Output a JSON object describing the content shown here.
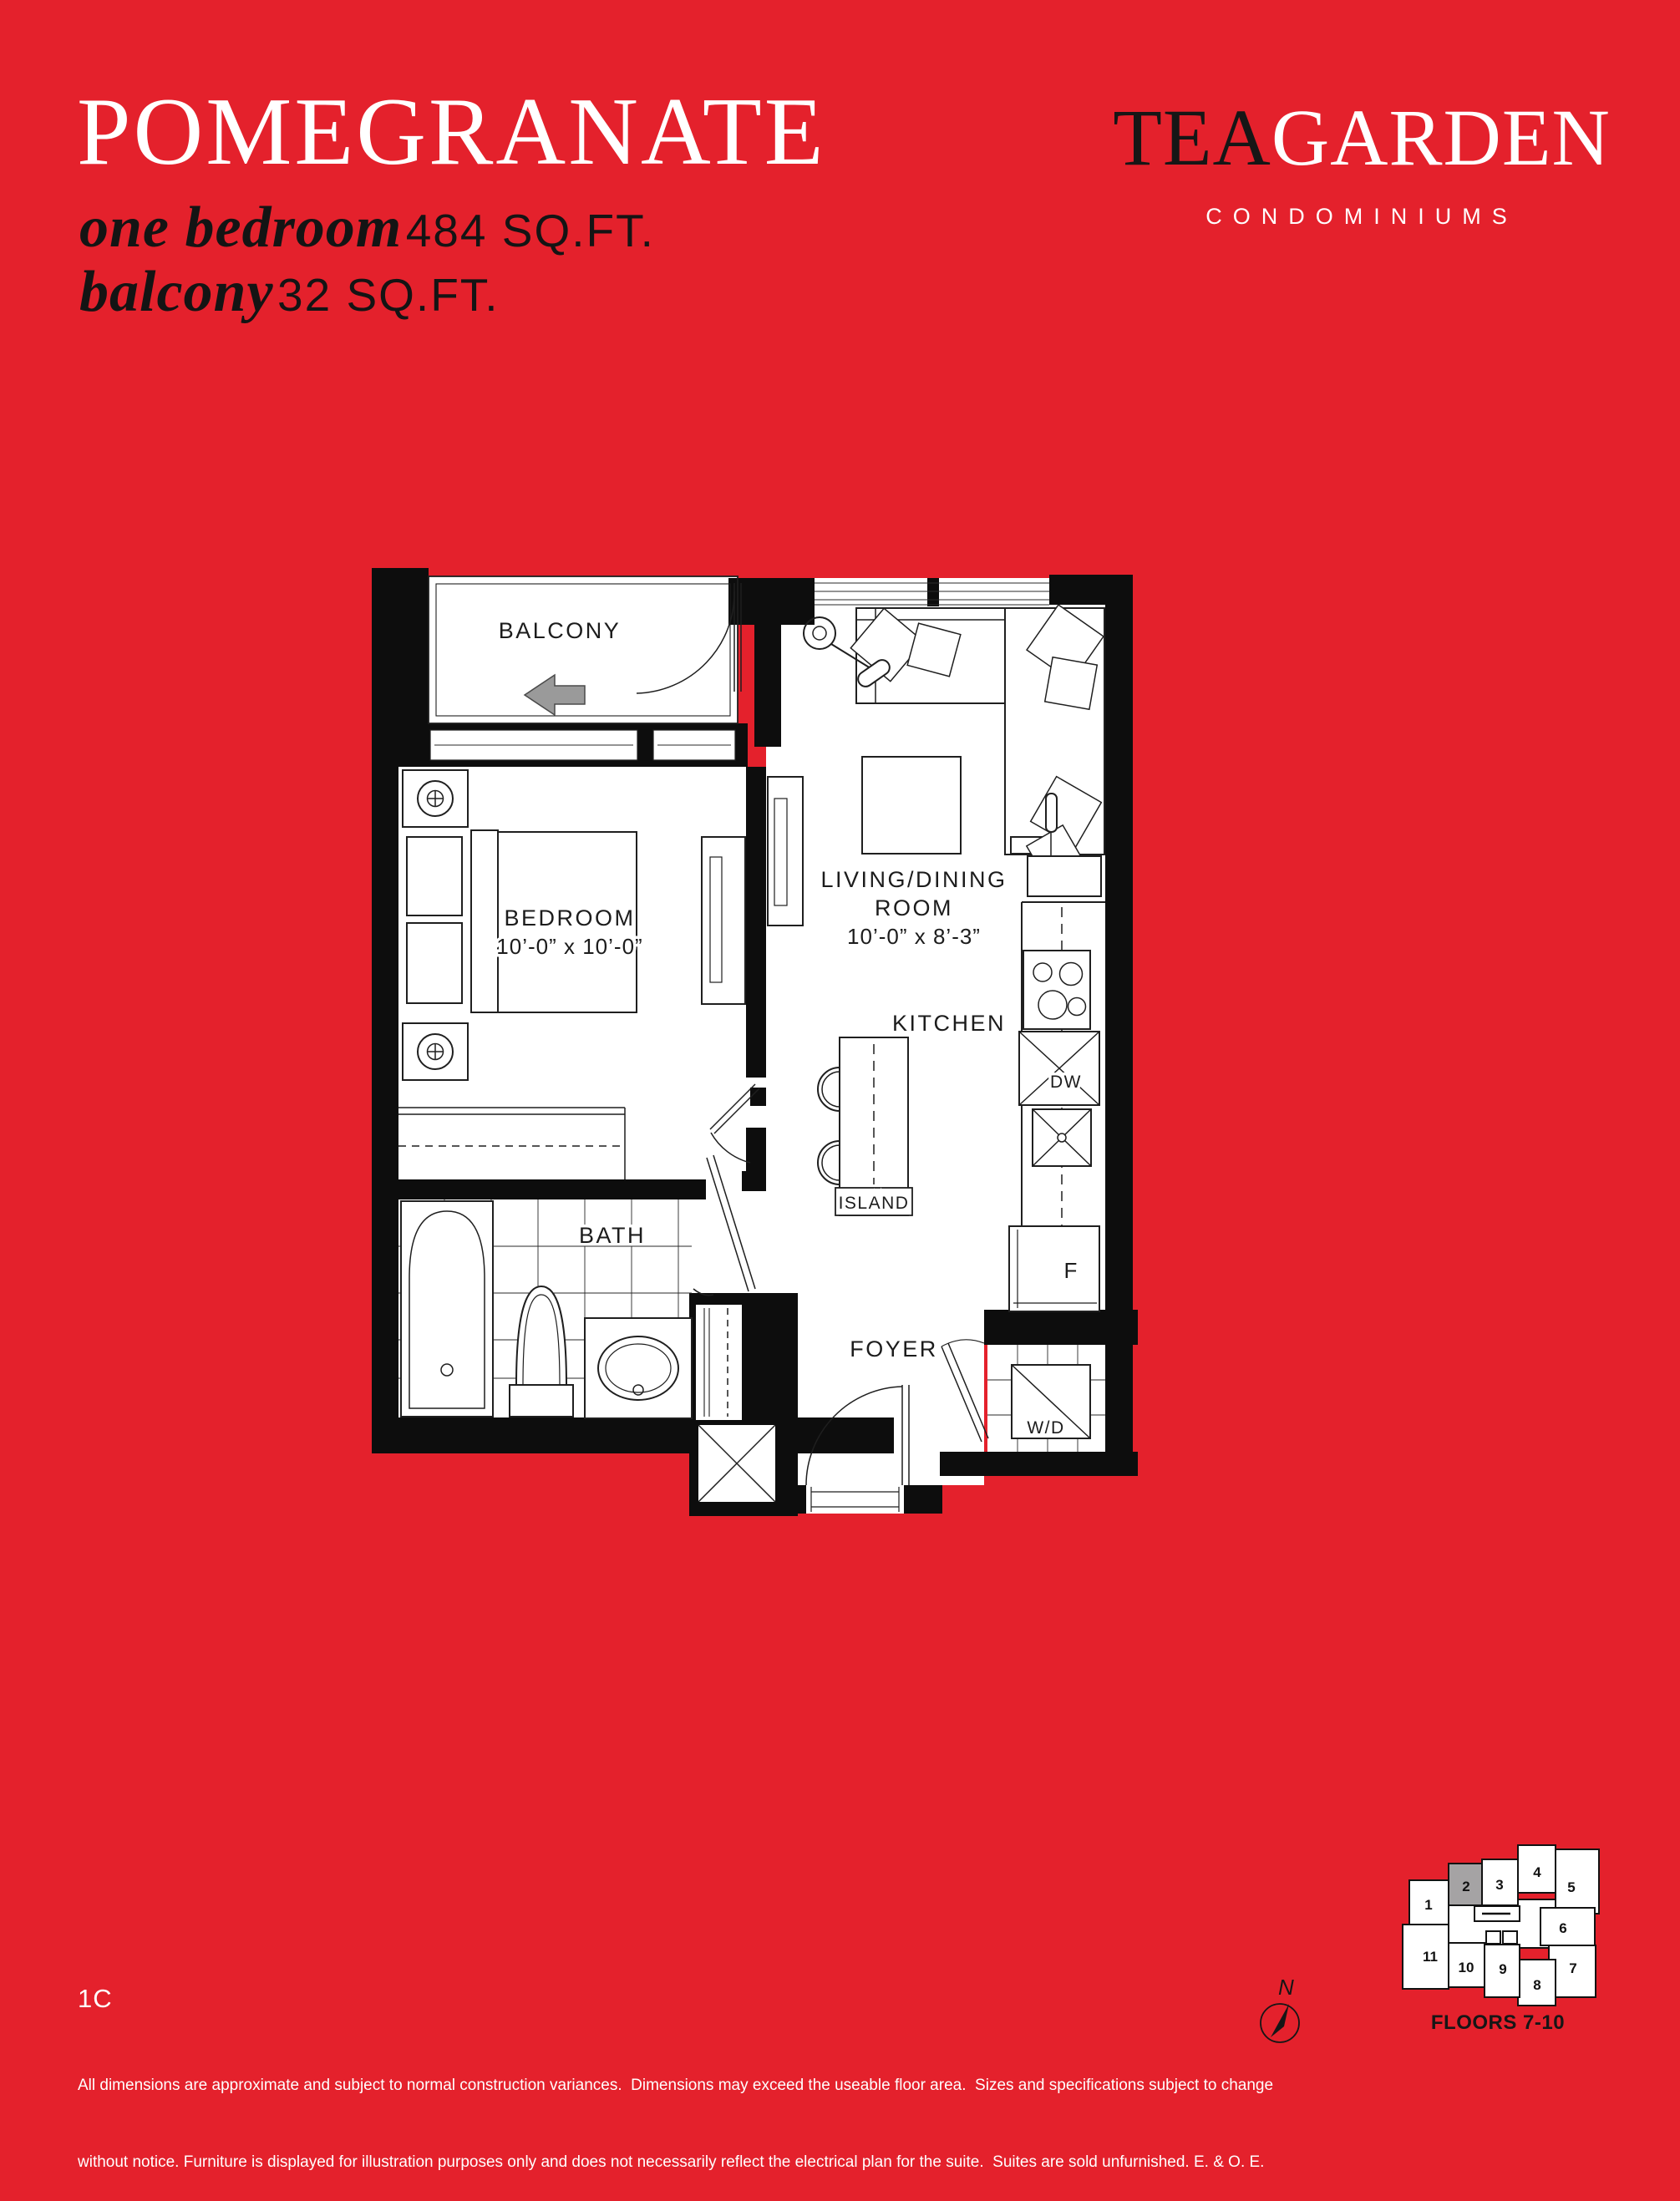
{
  "colors": {
    "background": "#e4212c",
    "ink_dark": "#141414",
    "white": "#ffffff",
    "arrow_gray": "#9a9a9a",
    "highlight_unit_gray": "#a5a3a4"
  },
  "header": {
    "plan_name": "POMEGRANATE",
    "suite_type": "one bedroom",
    "suite_area": "484 SQ.FT.",
    "balcony_type": "balcony",
    "balcony_area": "32 SQ.FT."
  },
  "brand": {
    "word_dark": "TEA",
    "word_light": "GARDEN",
    "tagline": "CONDOMINIUMS"
  },
  "plan": {
    "labels": {
      "balcony": "BALCONY",
      "bedroom": "BEDROOM",
      "bedroom_dims": "10’-0” x 10’-0”",
      "living_line1": "LIVING/DINING",
      "living_line2": "ROOM",
      "living_dims": "10’-0” x 8’-3”",
      "kitchen": "KITCHEN",
      "island": "ISLAND",
      "bath": "BATH",
      "foyer": "FOYER",
      "washer_dryer": "W/D",
      "fridge": "F",
      "dishwasher": "DW"
    }
  },
  "footer": {
    "unit_code": "1C",
    "disclaimer_line1": "All dimensions are approximate and subject to normal construction variances.  Dimensions may exceed the useable floor area.  Sizes and specifications subject to change",
    "disclaimer_line2": "without notice. Furniture is displayed for illustration purposes only and does not necessarily reflect the electrical plan for the suite.  Suites are sold unfurnished. E. & O. E."
  },
  "keyplan": {
    "floors_label": "FLOORS 7-10",
    "compass_label": "N",
    "highlighted_unit": "2",
    "units": [
      "1",
      "2",
      "3",
      "4",
      "5",
      "6",
      "7",
      "8",
      "9",
      "10",
      "11"
    ]
  }
}
